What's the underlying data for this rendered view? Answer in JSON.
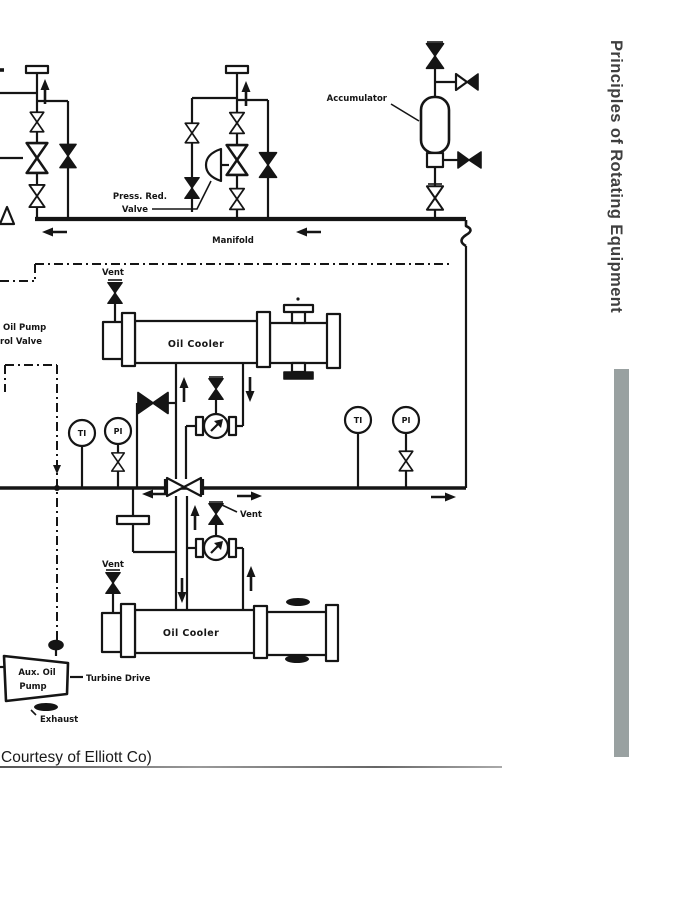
{
  "sidebar": {
    "title": "Principles of Rotating Equipment"
  },
  "caption": {
    "text": "Courtesy of Elliott Co)"
  },
  "diagram": {
    "labels": {
      "accumulator": "Accumulator",
      "press_red_line1": "Press. Red.",
      "press_red_line2": "Valve",
      "manifold": "Manifold",
      "pump_ctrl_line1": "Oil Pump",
      "pump_ctrl_line2": "rol Valve",
      "oil_cooler_upper": "Oil Cooler",
      "oil_cooler_lower": "Oil Cooler",
      "aux_pump_line1": "Aux. Oil",
      "aux_pump_line2": "Pump",
      "turbine_drive": "Turbine Drive",
      "exhaust": "Exhaust"
    },
    "vents": {
      "upper": "Vent",
      "filter": "Vent",
      "lower": "Vent"
    },
    "gauges": {
      "ti_left": "TI",
      "pi_left": "PI",
      "ti_right": "TI",
      "pi_right": "PI"
    },
    "colors": {
      "ink": "#151515",
      "background": "#ffffff",
      "sidebar_bar": "#99a1a1",
      "sidebar_text": "#3f3f3f"
    }
  }
}
